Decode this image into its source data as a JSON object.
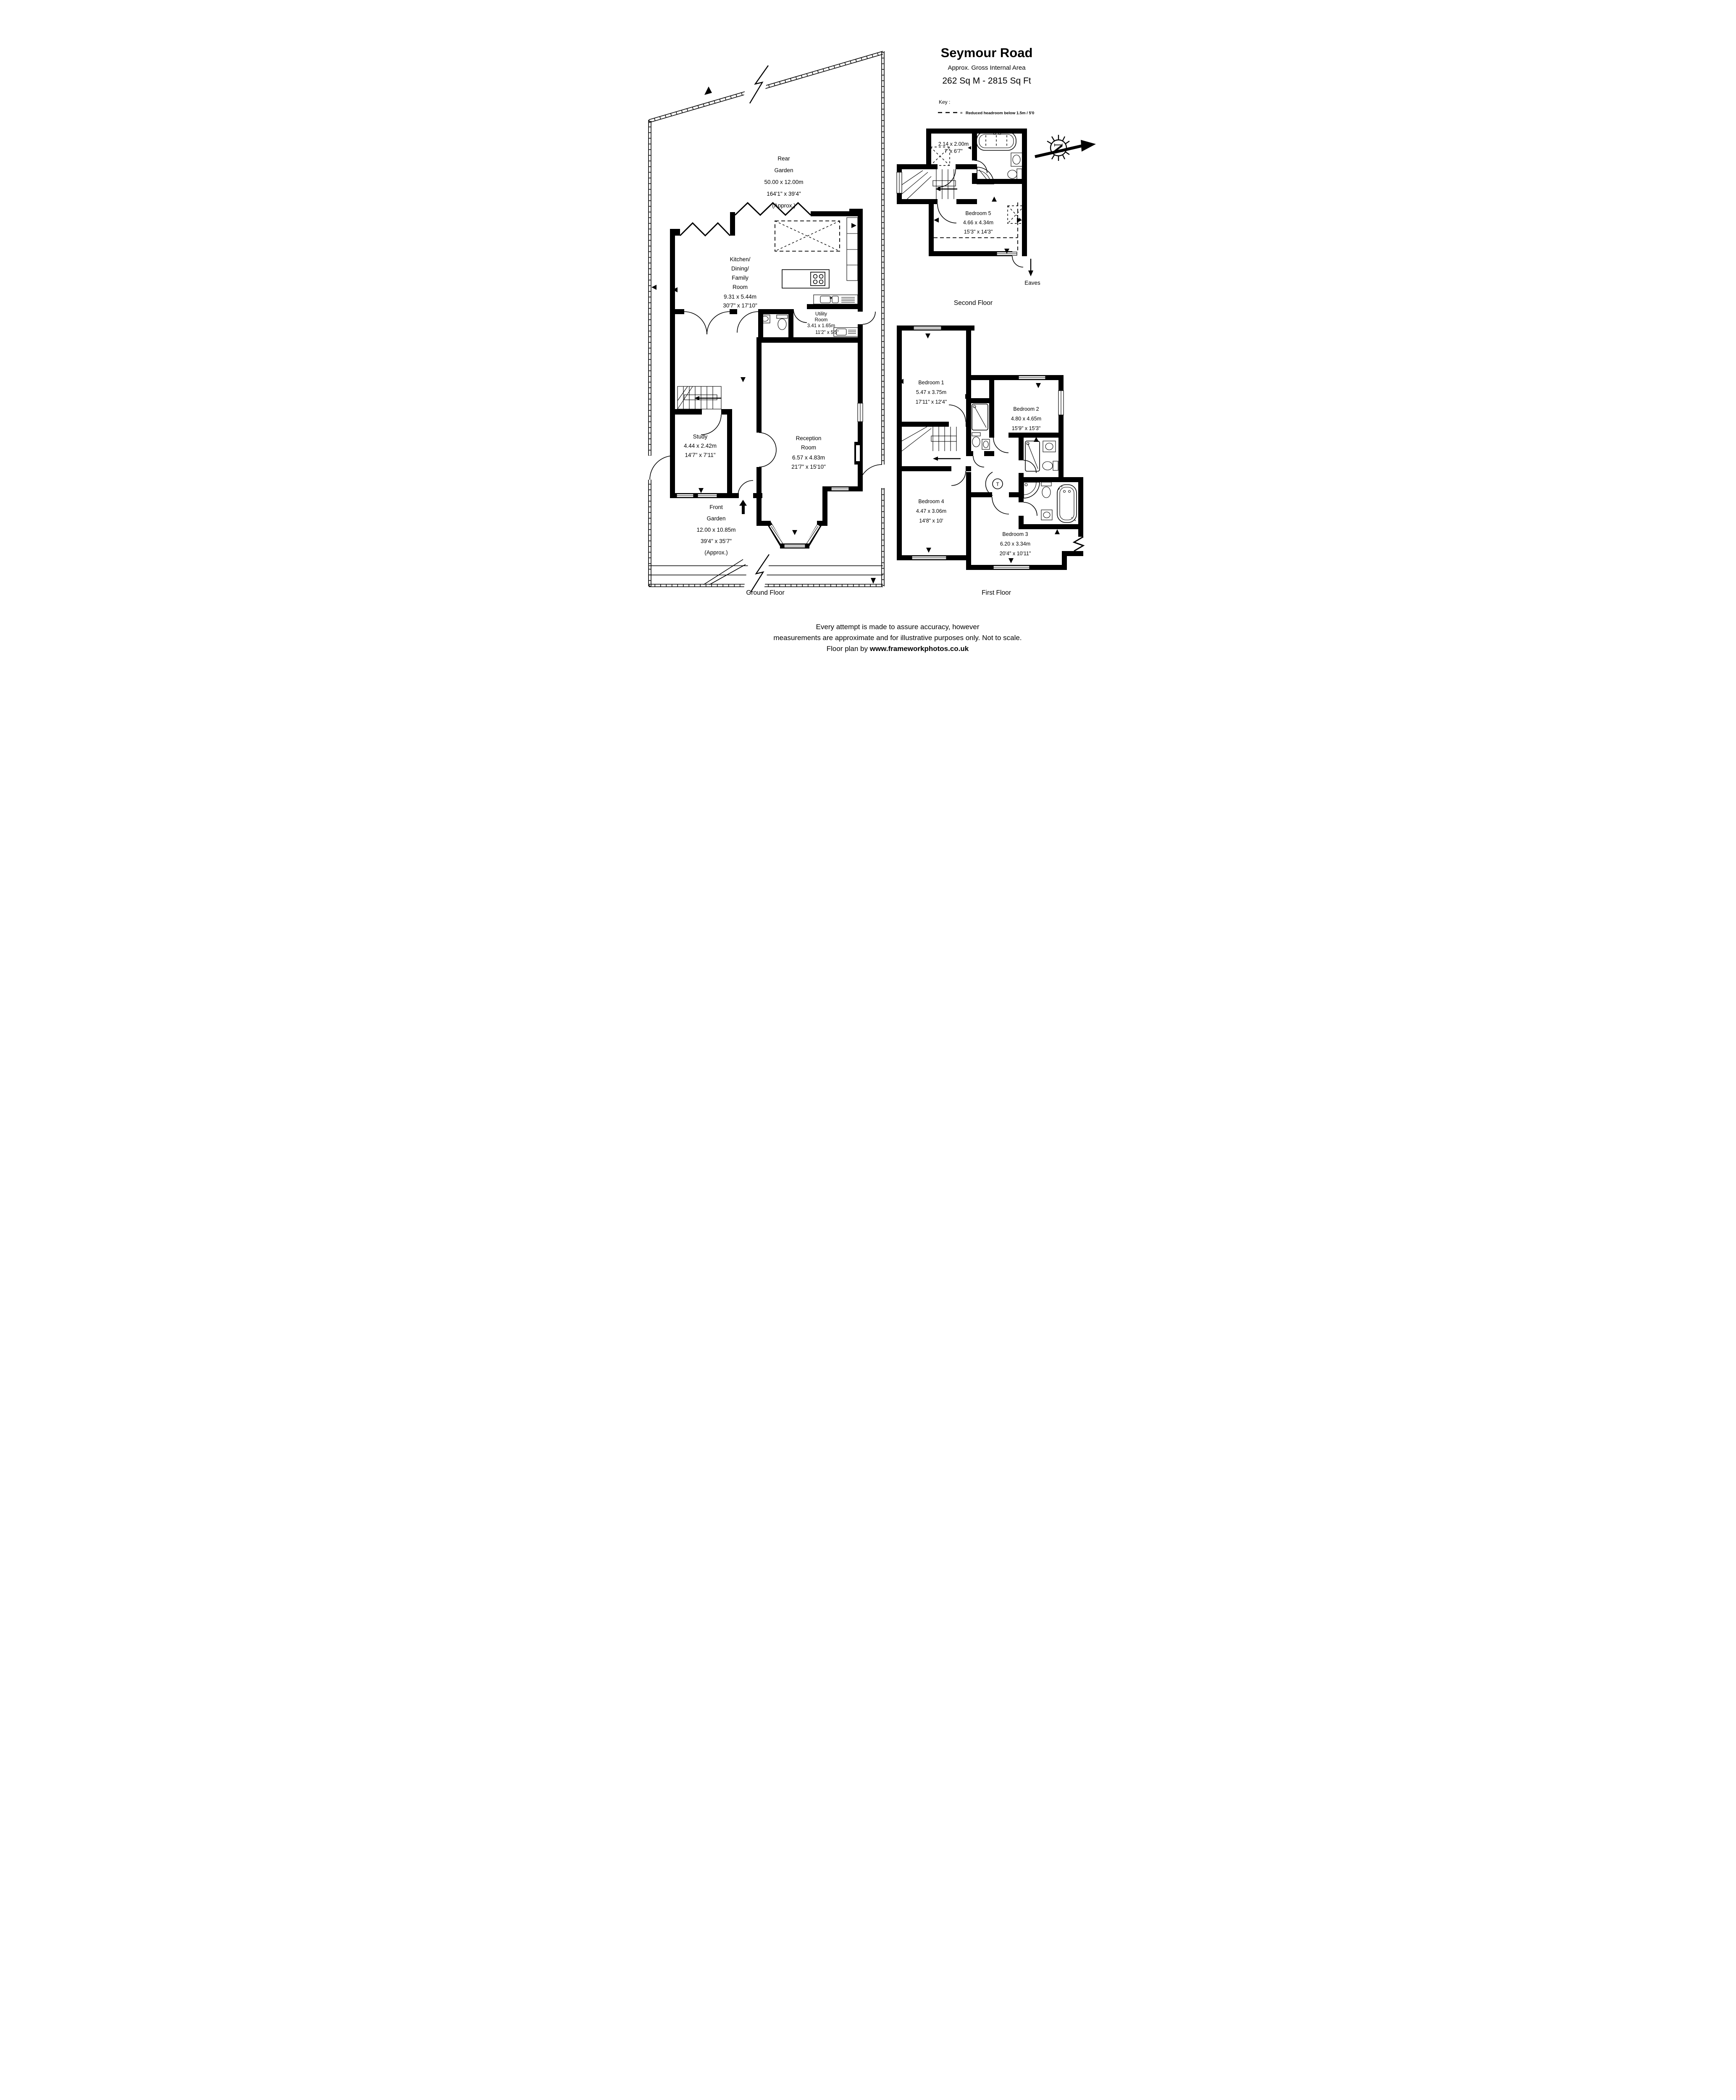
{
  "header": {
    "title": "Seymour Road",
    "subtitle": "Approx. Gross Internal Area",
    "area": "262 Sq M  -  2815 Sq Ft"
  },
  "key": {
    "label": "Key :",
    "equals": "=",
    "text": "Reduced  headroom below 1.5m / 5'0"
  },
  "compass": {
    "north": "N"
  },
  "floor_labels": {
    "ground": "Ground Floor",
    "first": "First Floor",
    "second": "Second Floor"
  },
  "rooms": {
    "rear_garden": {
      "l1": "Rear",
      "l2": "Garden",
      "l3": "50.00 x 12.00m",
      "l4": "164'1\" x 39'4\"",
      "l5": "(Approx.)"
    },
    "kitchen": {
      "l1": "Kitchen/",
      "l2": "Dining/",
      "l3": "Family",
      "l4": "Room",
      "l5": "9.31 x 5.44m",
      "l6": "30'7\" x 17'10\""
    },
    "utility": {
      "l1": "Utility",
      "l2": "Room",
      "l3": "3.41 x 1.65m",
      "l4": "11'2\" x 5'5\""
    },
    "reception": {
      "l1": "Reception",
      "l2": "Room",
      "l3": "6.57 x 4.83m",
      "l4": "21'7\" x 15'10\""
    },
    "study": {
      "l1": "Study",
      "l2": "4.44 x 2.42m",
      "l3": "14'7\" x 7'11\""
    },
    "front_garden": {
      "l1": "Front",
      "l2": "Garden",
      "l3": "12.00 x 10.85m",
      "l4": "39'4\" x 35'7\"",
      "l5": "(Approx.)"
    },
    "second_front_room": {
      "l1": "2.14 x 2.00m",
      "l2": "7' x 6'7\""
    },
    "bedroom5": {
      "l1": "Bedroom 5",
      "l2": "4.66 x 4.34m",
      "l3": "15'3\" x 14'3\""
    },
    "eaves": "Eaves",
    "bedroom1": {
      "l1": "Bedroom 1",
      "l2": "5.47 x 3.75m",
      "l3": "17'11\" x 12'4\""
    },
    "bedroom2": {
      "l1": "Bedroom 2",
      "l2": "4.80 x 4.65m",
      "l3": "15'9\" x 15'3\""
    },
    "bedroom3": {
      "l1": "Bedroom 3",
      "l2": "6.20 x 3.34m",
      "l3": "20'4\" x 10'11\""
    },
    "bedroom4": {
      "l1": "Bedroom 4",
      "l2": "4.47 x 3.06m",
      "l3": "14'8\" x 10'"
    },
    "tank": "T"
  },
  "footer": {
    "line1": "Every attempt is made to assure accuracy, however",
    "line2": "measurements are approximate and for illustrative purposes only. Not to scale.",
    "line3_prefix": "Floor plan by  ",
    "line3_url": "www.frameworkphotos.co.uk"
  },
  "colors": {
    "ink": "#000000",
    "paper": "#ffffff"
  }
}
